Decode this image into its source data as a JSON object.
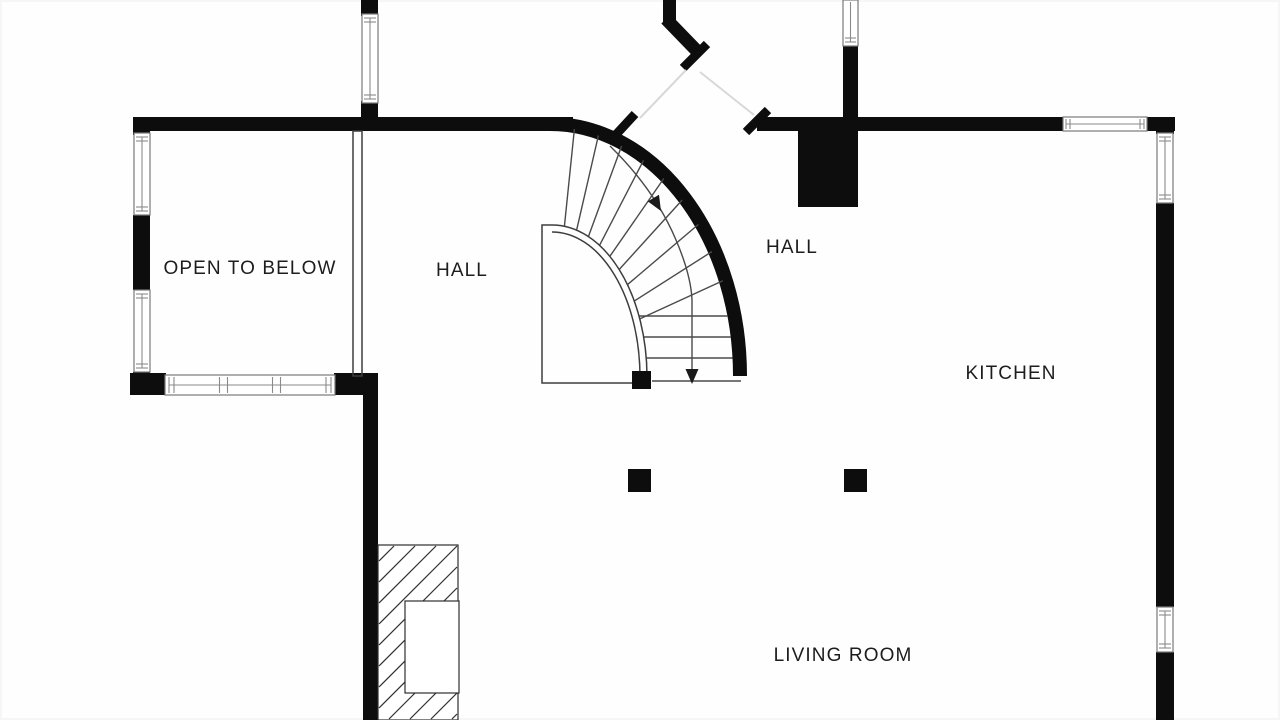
{
  "labels": {
    "open_to_below": "OPEN TO BELOW",
    "hall_left": "HALL",
    "hall_right": "HALL",
    "kitchen": "KITCHEN",
    "living_room": "LIVING ROOM"
  },
  "colors": {
    "wall": "#0d0d0d",
    "stair_line": "#4a4a4a",
    "window_line": "#7a7a7a",
    "thin_partition_line": "#3d3d3d",
    "passage_line": "#d8d8d8",
    "text": "#1d1d1d",
    "background": "#ffffff"
  }
}
